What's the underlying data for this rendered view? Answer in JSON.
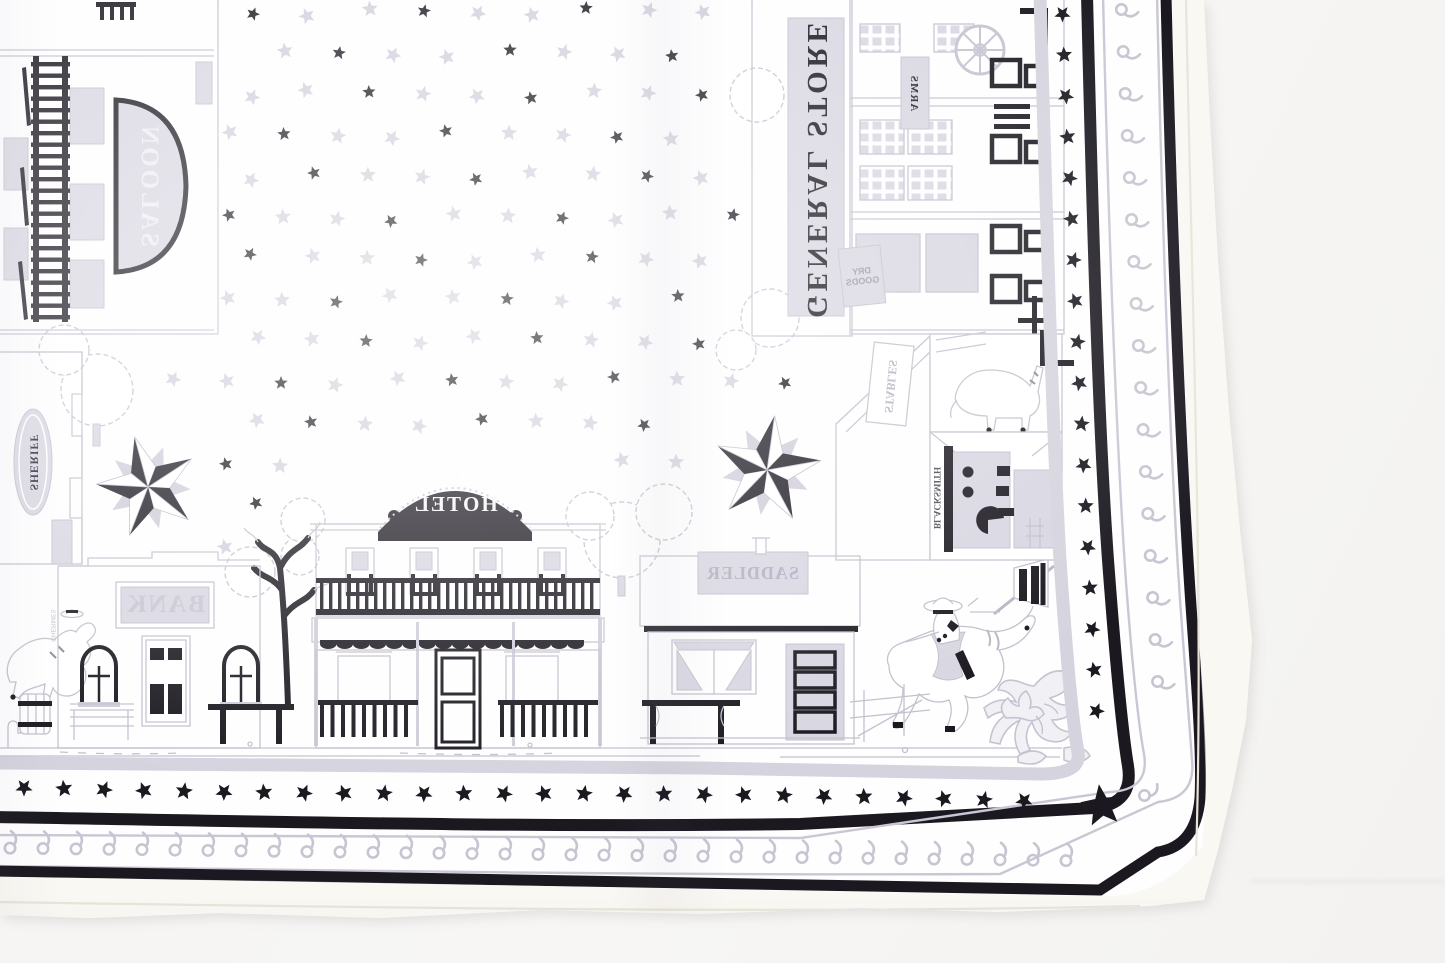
{
  "signs": {
    "saloon": "SALOON",
    "general_store": "GENERAL STORE",
    "arms": "ARMS",
    "dry_goods": "DRY GOODS",
    "stables": "STABLES",
    "blacksmith": "BLACKSMITH",
    "sheriff": "SHERIFF",
    "bank": "BANK",
    "hotel": "HOTEL",
    "saddler": "SADDLER",
    "copyright": "©HERMES"
  },
  "palette": {
    "print_black": "#1b1820",
    "print_gray": "#c8c5d2",
    "print_gray_light": "#d8d6e1",
    "outline_gray": "#c3c0cd",
    "scarf_white": "#fffeff",
    "hem_cream": "#f5f2ea",
    "photo_background": "#f5f4f3"
  },
  "motifs": {
    "starfield_star_colors": [
      "#c8c5d2",
      "#1b1820"
    ],
    "nautical_star_count": 2,
    "border_bands": [
      "gray inner band",
      "black star row",
      "thick black line",
      "gray paisley scroll band",
      "thick black line",
      "white hem"
    ],
    "figures": [
      "cowboy on bucking horse",
      "rider on horse",
      "horse in stable",
      "striped pennant",
      "corner floral scroll",
      "bare tree",
      "wagon wheel",
      "barrel",
      "bench",
      "hitching rail"
    ]
  }
}
